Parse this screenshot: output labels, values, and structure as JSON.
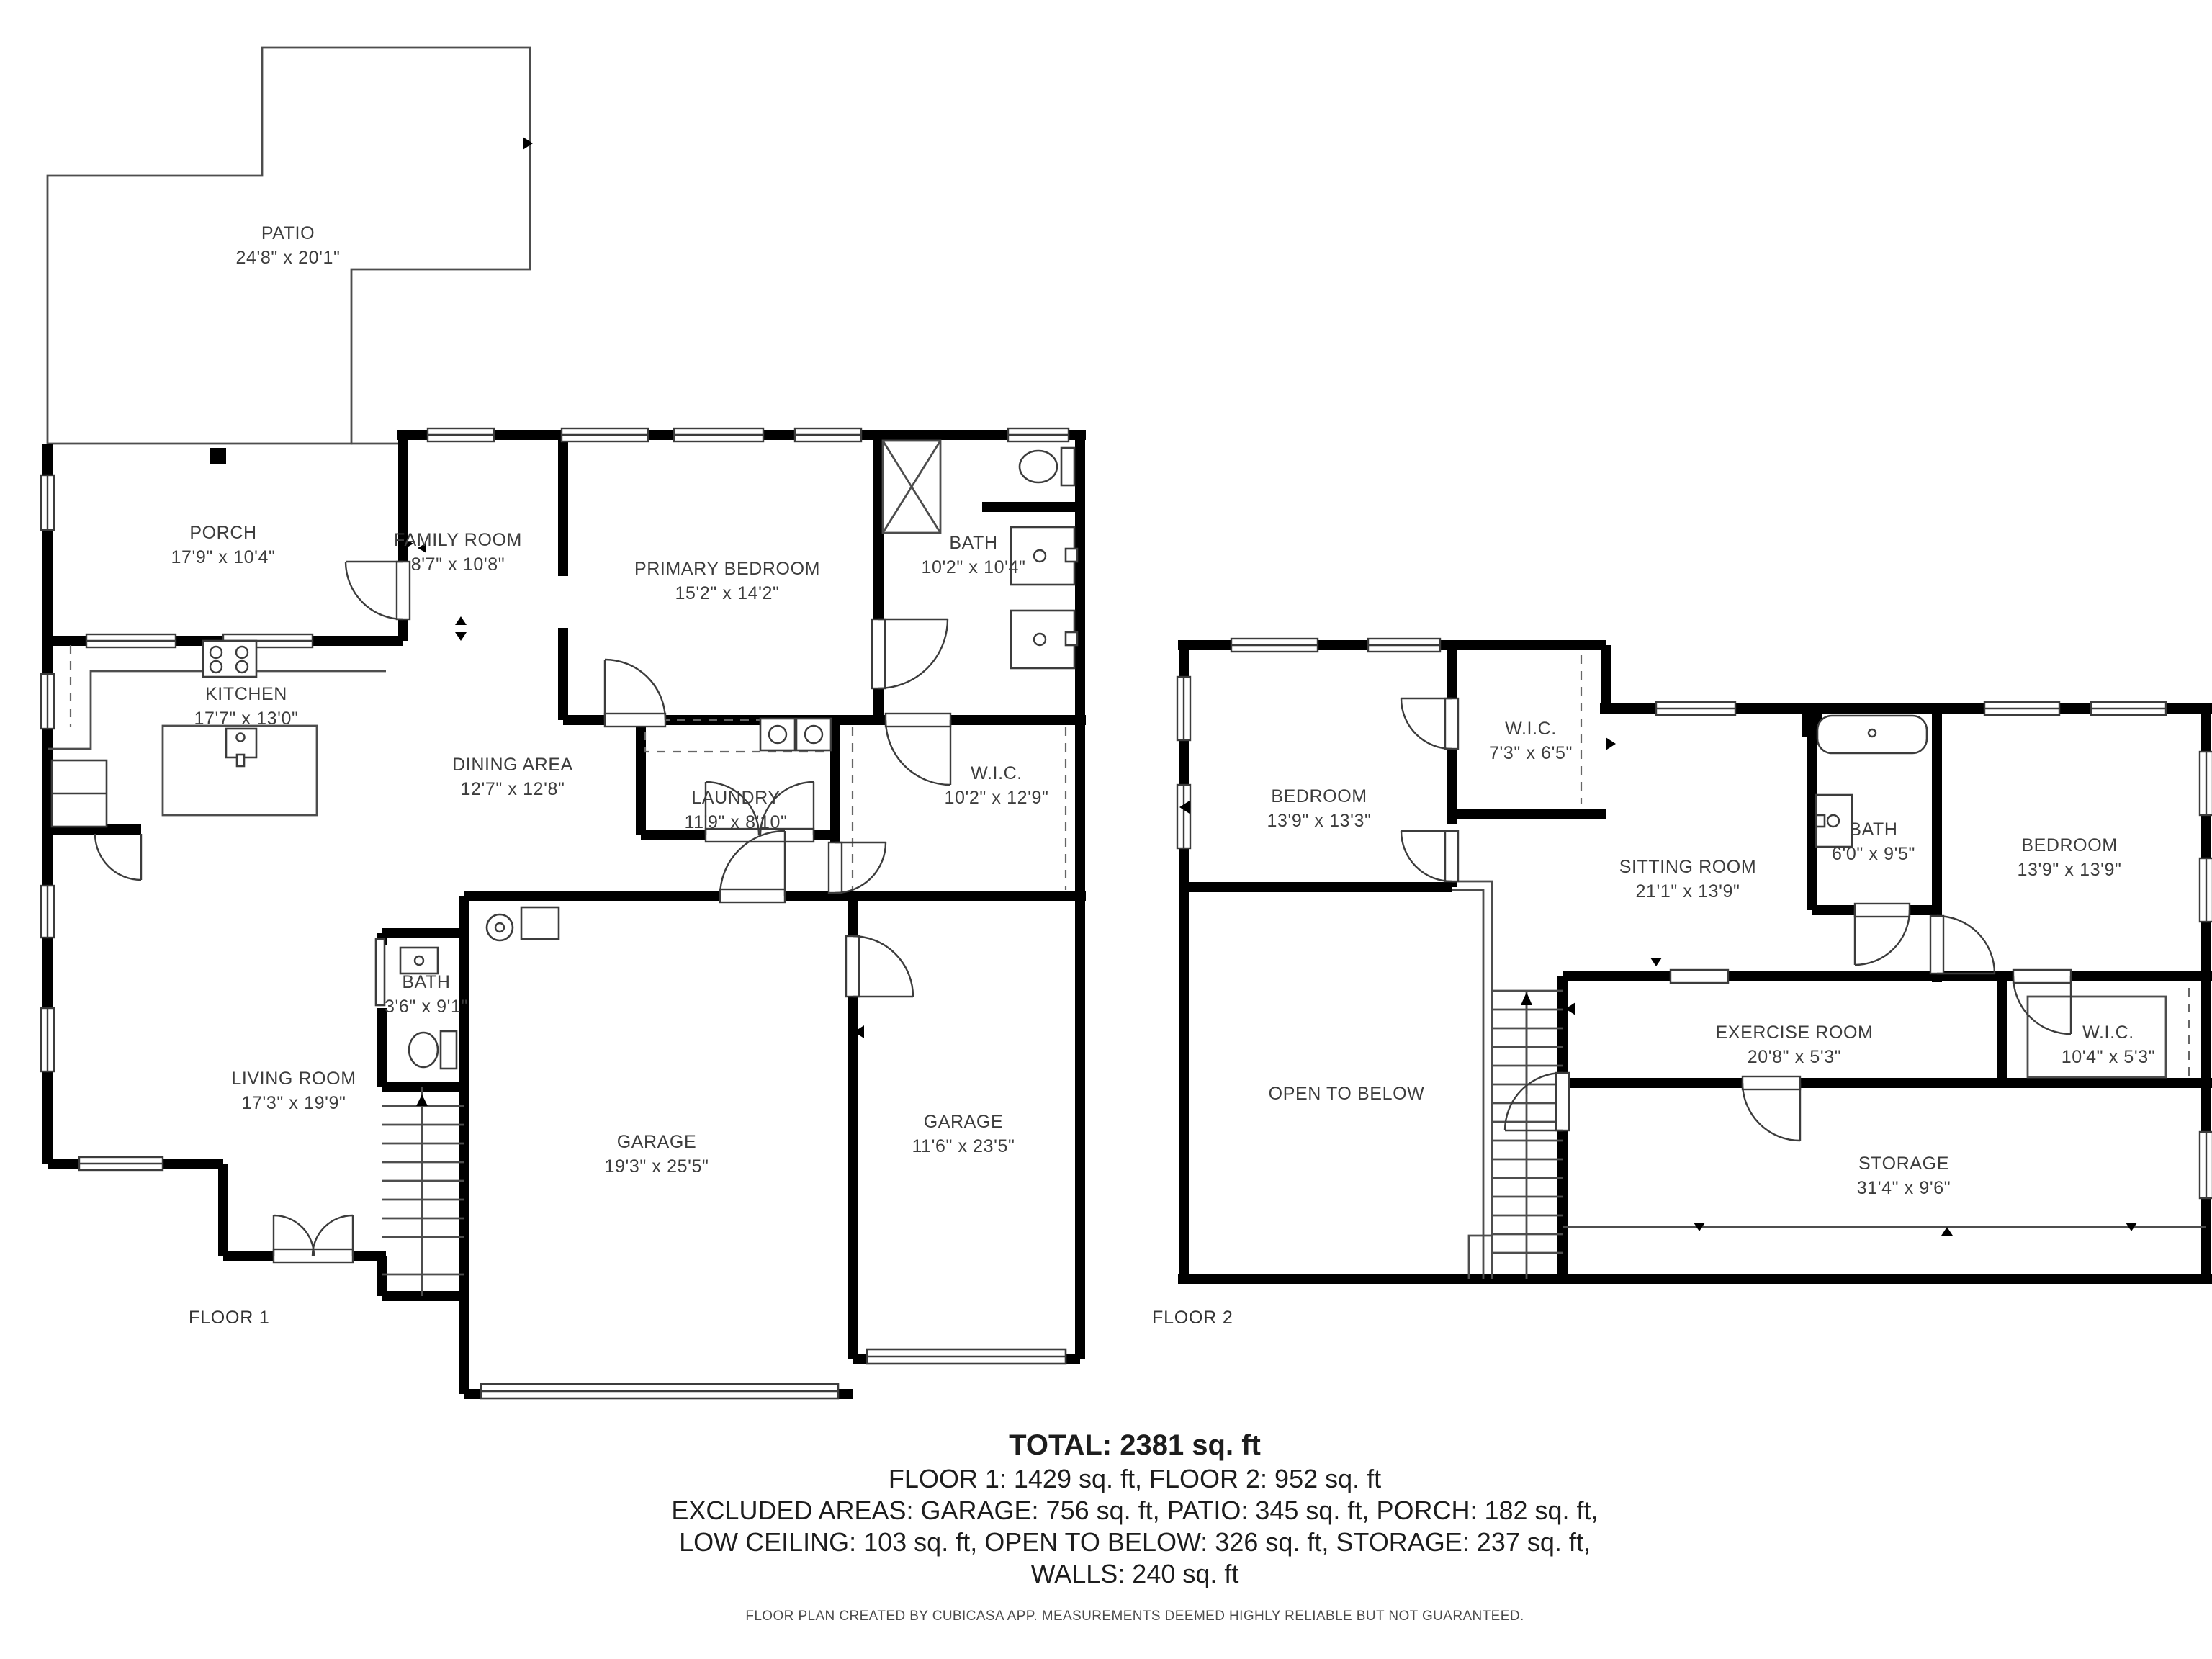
{
  "colors": {
    "wall": "#000000",
    "thin_line": "#4d4d4d",
    "text": "#3f3f3f"
  },
  "floor1": {
    "label": "FLOOR 1",
    "rooms": {
      "patio": {
        "name": "PATIO",
        "dims": "24'8\" x 20'1\""
      },
      "porch": {
        "name": "PORCH",
        "dims": "17'9\" x 10'4\""
      },
      "family_room": {
        "name": "FAMILY ROOM",
        "dims": "8'7\" x 10'8\""
      },
      "primary_bedroom": {
        "name": "PRIMARY BEDROOM",
        "dims": "15'2\" x 14'2\""
      },
      "bath": {
        "name": "BATH",
        "dims": "10'2\" x 10'4\""
      },
      "kitchen": {
        "name": "KITCHEN",
        "dims": "17'7\" x 13'0\""
      },
      "dining_area": {
        "name": "DINING AREA",
        "dims": "12'7\" x 12'8\""
      },
      "laundry": {
        "name": "LAUNDRY",
        "dims": "11'9\" x 8'10\""
      },
      "wic": {
        "name": "W.I.C.",
        "dims": "10'2\" x 12'9\""
      },
      "bath2": {
        "name": "BATH",
        "dims": "3'6\" x 9'1\""
      },
      "living_room": {
        "name": "LIVING ROOM",
        "dims": "17'3\" x 19'9\""
      },
      "garage1": {
        "name": "GARAGE",
        "dims": "19'3\" x 25'5\""
      },
      "garage2": {
        "name": "GARAGE",
        "dims": "11'6\" x 23'5\""
      }
    }
  },
  "floor2": {
    "label": "FLOOR 2",
    "rooms": {
      "bedroom1": {
        "name": "BEDROOM",
        "dims": "13'9\" x 13'3\""
      },
      "wic1": {
        "name": "W.I.C.",
        "dims": "7'3\" x 6'5\""
      },
      "sitting_room": {
        "name": "SITTING ROOM",
        "dims": "21'1\" x 13'9\""
      },
      "bath": {
        "name": "BATH",
        "dims": "6'0\" x 9'5\""
      },
      "bedroom2": {
        "name": "BEDROOM",
        "dims": "13'9\" x 13'9\""
      },
      "exercise_room": {
        "name": "EXERCISE ROOM",
        "dims": "20'8\" x 5'3\""
      },
      "wic2": {
        "name": "W.I.C.",
        "dims": "10'4\" x 5'3\""
      },
      "open_to_below": {
        "name": "OPEN TO BELOW",
        "dims": ""
      },
      "storage": {
        "name": "STORAGE",
        "dims": "31'4\" x 9'6\""
      }
    }
  },
  "summary": {
    "total": "TOTAL: 2381 sq. ft",
    "floors": "FLOOR 1: 1429 sq. ft, FLOOR 2: 952 sq. ft",
    "excluded1": "EXCLUDED AREAS: GARAGE: 756 sq. ft, PATIO: 345 sq. ft, PORCH: 182 sq. ft,",
    "excluded2": "LOW CEILING: 103 sq. ft, OPEN TO BELOW: 326 sq. ft, STORAGE: 237 sq. ft,",
    "walls": "WALLS: 240 sq. ft"
  },
  "footer": "FLOOR PLAN CREATED BY CUBICASA APP. MEASUREMENTS DEEMED HIGHLY RELIABLE BUT NOT GUARANTEED."
}
